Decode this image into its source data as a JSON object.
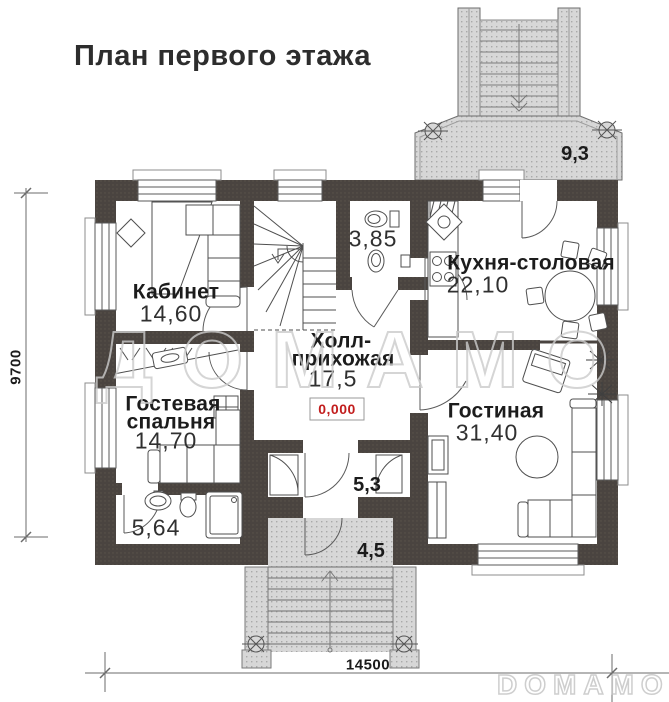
{
  "title": "План первого этажа",
  "watermarks": {
    "center": "ДОМАМО",
    "corner": "DOMAMO"
  },
  "level_mark": "0,000",
  "dimensions": {
    "bottom": "14500",
    "left": "9700"
  },
  "rooms": {
    "office": {
      "name": "Кабинет",
      "area": "14,60"
    },
    "guest_bedroom": {
      "name_line1": "Гостевая",
      "name_line2": "спальня",
      "area": "14,70"
    },
    "bathroom": {
      "area": "5,64"
    },
    "hall": {
      "name_line1": "Холл-",
      "name_line2": "прихожая",
      "area": "17,5"
    },
    "wc": {
      "area": "3,85"
    },
    "kitchen": {
      "name": "Кухня-столовая",
      "area": "22,10"
    },
    "living": {
      "name": "Гостиная",
      "area": "31,40"
    },
    "vestibule": {
      "area": "5,3"
    },
    "porch": {
      "area": "4,5"
    },
    "terrace": {
      "area": "9,3"
    }
  },
  "colors": {
    "wall": "#4a4440",
    "stipple": "#d7d7d7",
    "accent_red": "#c21d1d",
    "watermark": "#cbcbcb"
  }
}
